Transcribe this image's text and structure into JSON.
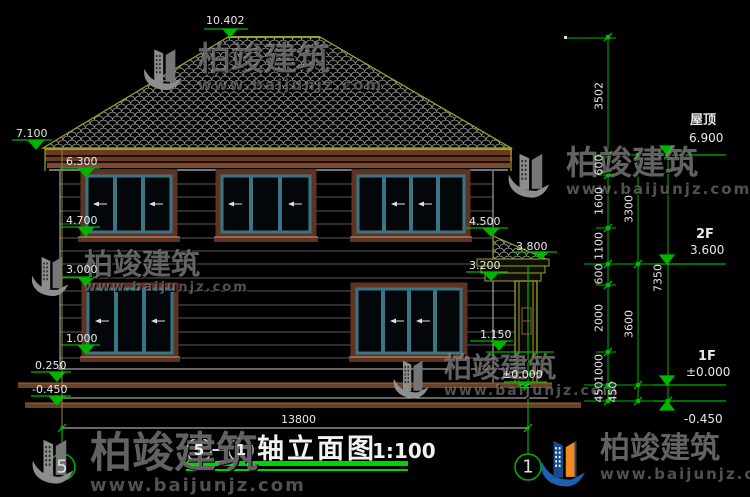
{
  "drawing": {
    "top_marker": "10.402",
    "left_markers": [
      "7.100",
      "6.300",
      "4.700",
      "3.000",
      "1.000",
      "0.250",
      "-0.450"
    ],
    "inner_markers": {
      "roof_side": "4.500",
      "porch_peak": "3.800",
      "porch_cornice": "3.200",
      "railing": "1.150",
      "porch_floor": "±0.000"
    },
    "right_levels": [
      {
        "label": "屋顶",
        "value": "6.900"
      },
      {
        "label": "2F",
        "value": "3.600"
      },
      {
        "label": "1F",
        "value": "±0.000"
      },
      {
        "label": "",
        "value": "-0.450"
      }
    ],
    "dims": {
      "chain_inner": [
        "3502",
        "600",
        "1600",
        "1100",
        "600",
        "2000",
        "1000",
        "450"
      ],
      "chain_mid": [
        "3300",
        "3600",
        "450"
      ],
      "total_height": "7350",
      "total_width": "13800"
    },
    "axis_bubbles": {
      "left": "5",
      "right": "1"
    },
    "title": {
      "axis_left": "5",
      "axis_right": "1",
      "name": "轴立面图",
      "scale": "1:100"
    }
  },
  "watermark": {
    "brand": "柏竣建筑",
    "url": "www.baijunjz.com"
  },
  "colors": {
    "dim_green": "#00b400",
    "underline_green": "#00d400",
    "roof_outline": "#9aa02c",
    "window_frame": "#3a7585",
    "trim_brown": "#6b3a24",
    "text_white": "#e8e8e8"
  }
}
